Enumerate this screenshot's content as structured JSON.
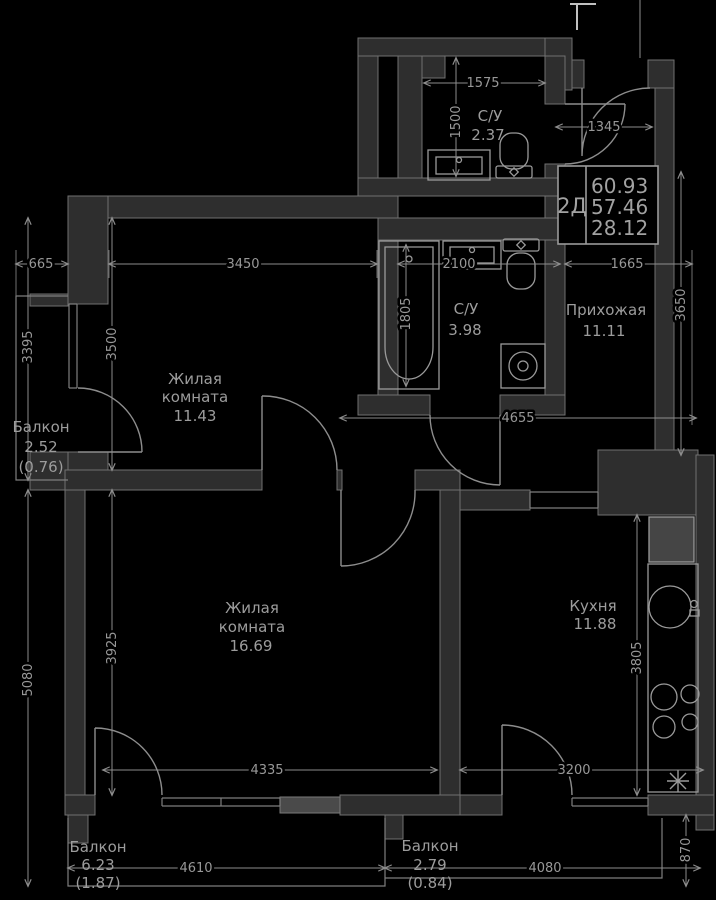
{
  "info_box": {
    "plan_code": "2Д",
    "area_total": "60.93",
    "area_living_total": "57.46",
    "area_rooms": "28.12"
  },
  "rooms": {
    "bathroom_top": {
      "name": "С/У",
      "area": "2.37"
    },
    "bathroom_main": {
      "name": "С/У",
      "area": "3.98"
    },
    "hallway": {
      "name": "Прихожая",
      "area": "11.11"
    },
    "bedroom": {
      "name_line1": "Жилая",
      "name_line2": "комната",
      "area": "11.43"
    },
    "living_room": {
      "name_line1": "Жилая",
      "name_line2": "комната",
      "area": "16.69"
    },
    "kitchen": {
      "name": "Кухня",
      "area": "11.88"
    },
    "balcony_left": {
      "name": "Балкон",
      "area": "2.52",
      "area_reduced": "(0.76)"
    },
    "balcony_bottom_left": {
      "name": "Балкон",
      "area": "6.23",
      "area_reduced": "(1.87)"
    },
    "balcony_bottom_right": {
      "name": "Балкон",
      "area": "2.79",
      "area_reduced": "(0.84)"
    }
  },
  "dimensions": {
    "top_bath_width": "1575",
    "top_bath_height": "1500",
    "entry_width": "1345",
    "balcony_left_width": "665",
    "bedroom_width": "3450",
    "bathroom_width": "2100",
    "hall_width": "1665",
    "balcony_left_height": "3395",
    "bedroom_height": "3500",
    "bathtub_length": "1805",
    "hall_height": "3650",
    "corridor_width": "4655",
    "left_lower_height": "5080",
    "living_height": "3925",
    "kitchen_height": "3805",
    "living_width": "4335",
    "kitchen_width": "3200",
    "balcony_bottom_left_width": "4610",
    "balcony_bottom_right_width": "4080",
    "balcony_bottom_right_height": "870"
  },
  "colors": {
    "background": "#000000",
    "wall_fill": "#2e2e2e",
    "line": "#8d8d8d",
    "text": "#9a9a9a"
  }
}
